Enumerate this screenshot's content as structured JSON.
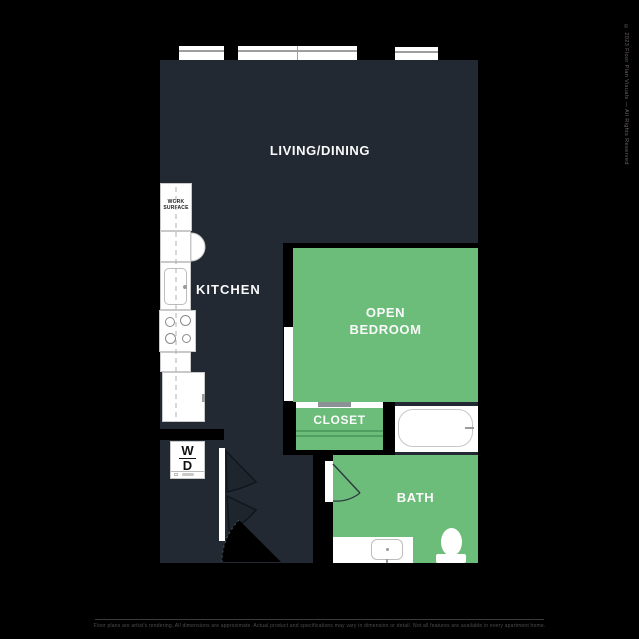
{
  "canvas": {
    "width": 639,
    "height": 639
  },
  "colors": {
    "background": "#000000",
    "floor_dark": "#232932",
    "room_green": "#6dbd7a",
    "closet_rod_green": "#4f9f61",
    "fixture_white": "#ffffff",
    "fixture_outline": "#c9c9c9",
    "window_mullion": "#9e9e9e",
    "sliding_door_gray": "#8c9196",
    "door_line_dark": "#10161d",
    "footer_text": "#4e4e4e",
    "watermark_text": "#6d6165"
  },
  "rooms": {
    "living_dining": {
      "label": "LIVING/DINING"
    },
    "kitchen": {
      "label": "KITCHEN"
    },
    "open_bedroom": {
      "line1": "OPEN",
      "line2": "BEDROOM"
    },
    "closet": {
      "label": "CLOSET"
    },
    "bath": {
      "label": "BATH"
    }
  },
  "fixtures": {
    "work_surface": {
      "line1": "WORK",
      "line2": "SURFACE"
    },
    "washer_dryer": {
      "washer": "W",
      "dryer": "D"
    }
  },
  "footer": {
    "disclaimer": "Floor plans are artist's rendering. All dimensions are approximate. Actual product and specifications may vary in dimension or detail. Not all features are available in every apartment home."
  },
  "watermark": "© 2023 Floor Plan Visuals — All Rights Reserved"
}
